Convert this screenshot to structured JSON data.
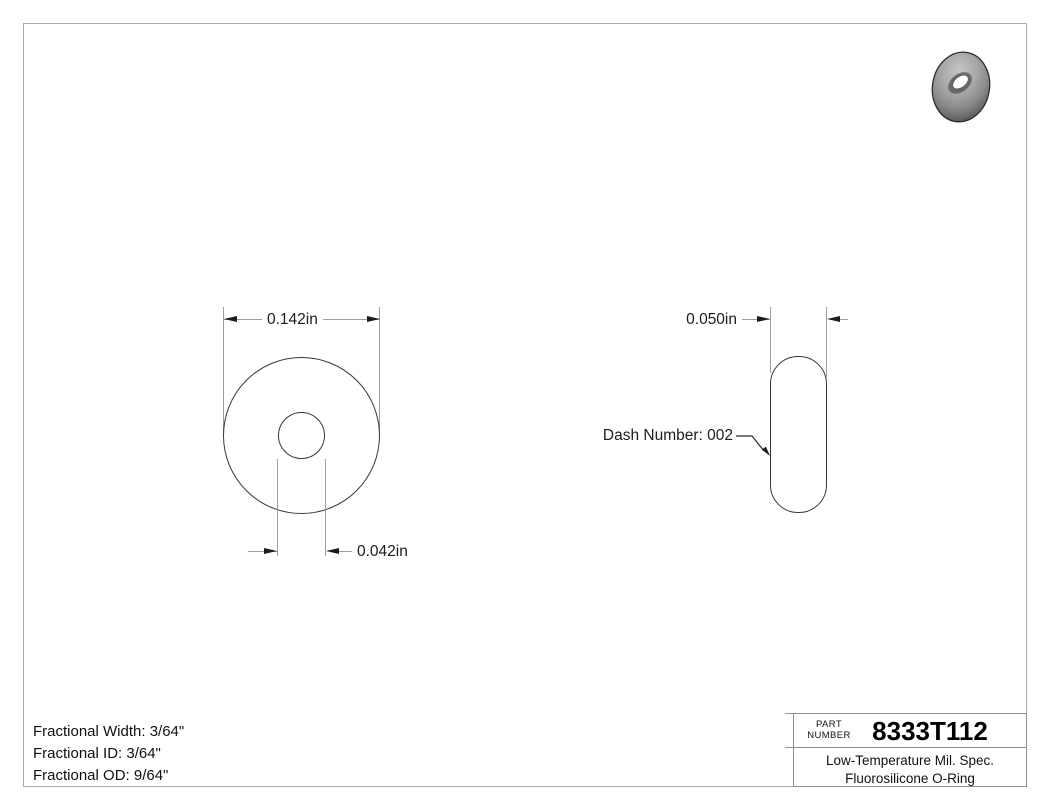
{
  "colors": {
    "outline": "#383838",
    "construction_line": "#9e9e9e",
    "arrow": "#1c1c1c",
    "text": "#1c1c1c",
    "page_frame": "#ababab",
    "title_block_border": "#8e8e8e",
    "torus_body": "#8f8f8f"
  },
  "front_view": {
    "outer_diameter_label": "0.142in",
    "inner_diameter_label": "0.042in"
  },
  "side_view": {
    "width_label": "0.050in",
    "dash_number_label": "Dash Number: 002"
  },
  "notes": {
    "lines": [
      "Fractional Width: 3/64\"",
      "Fractional ID: 3/64\"",
      "Fractional OD: 9/64\""
    ]
  },
  "title_block": {
    "part_label": [
      "PART",
      "NUMBER"
    ],
    "part_number": "8333T112",
    "description": [
      "Low-Temperature Mil. Spec.",
      "Fluorosilicone O-Ring"
    ]
  },
  "icons": {
    "o_ring_render": "3d-torus-product-image"
  }
}
